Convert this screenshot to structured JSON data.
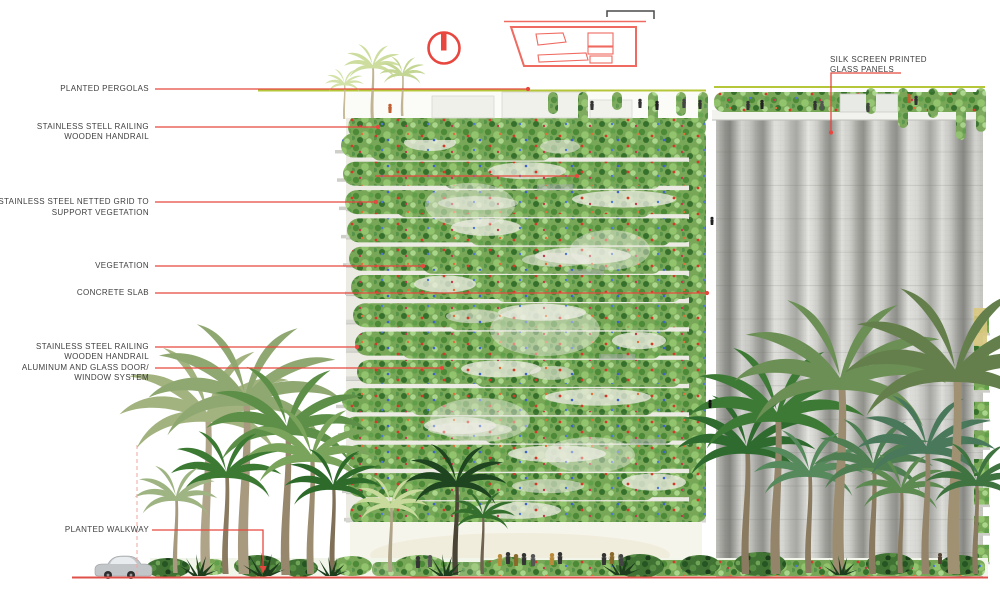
{
  "figure": {
    "type": "annotated architectural elevation",
    "annotation_color": "#e8473f",
    "label_color": "#3f3f3f",
    "pergola_line_color": "#b5c638",
    "ground_line_color": "#e0504a"
  },
  "icons": {
    "section_marker": "section-marker-icon",
    "key_plan": "key-plan-diagram",
    "scale_bracket": "scale-bracket-icon"
  },
  "labels": {
    "left": [
      {
        "lines": [
          "PLANTED PERGOLAS"
        ]
      },
      {
        "lines": [
          "STAINLESS STELL RAILING",
          "WOODEN HANDRAIL"
        ]
      },
      {
        "lines": [
          "STAINLESS STEEL NETTED GRID TO",
          "SUPPORT VEGETATION"
        ]
      },
      {
        "lines": [
          "VEGETATION"
        ]
      },
      {
        "lines": [
          "CONCRETE SLAB"
        ]
      },
      {
        "lines": [
          "STAINLESS STEEL RAILING",
          "WOODEN HANDRAIL"
        ]
      },
      {
        "lines": [
          "ALUMINUM AND GLASS DOOR/",
          "WINDOW SYSTEM"
        ]
      },
      {
        "lines": [
          "PLANTED WALKWAY"
        ]
      }
    ],
    "right": [
      {
        "lines": [
          "SILK SCREEN PRINTED",
          "GLASS PANELS"
        ]
      }
    ]
  }
}
